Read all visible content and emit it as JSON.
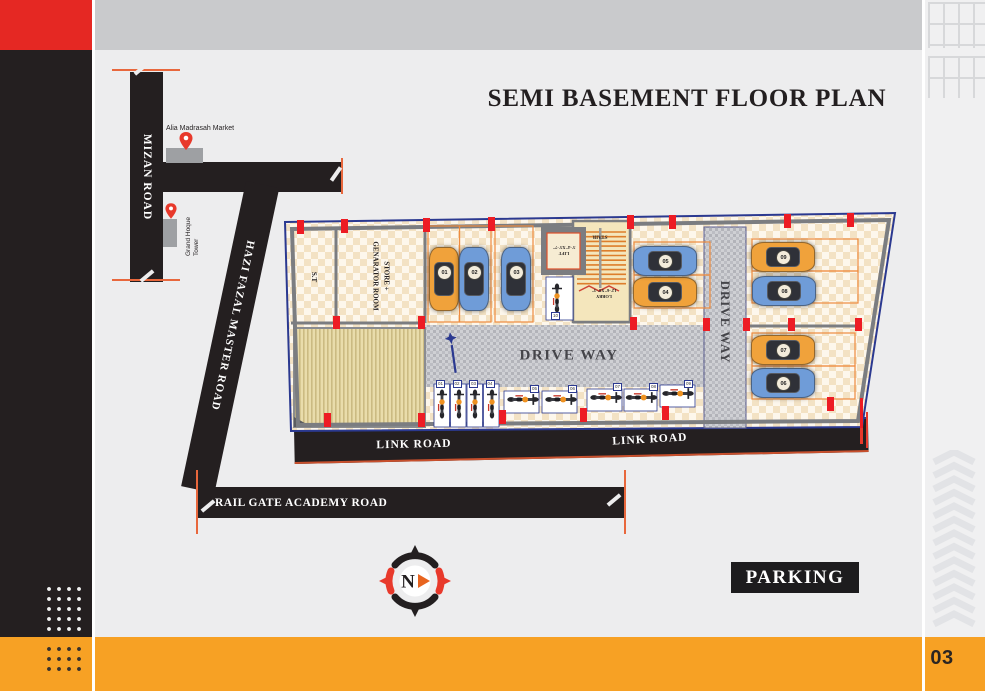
{
  "page": {
    "title": "SEMI BASEMENT FLOOR PLAN",
    "parking_badge": "PARKING",
    "page_number": "03",
    "colors": {
      "accent_red": "#ED1C24",
      "accent_orange": "#F7A124",
      "ink_black": "#231F20",
      "outline_navy": "#2B3990"
    }
  },
  "roads": {
    "mizan": "MIZAN ROAD",
    "hazi_fazal": "HAZI FAZAL MASTER ROAD",
    "link": "LINK ROAD",
    "rail_gate": "RAIL GATE ACADEMY ROAD"
  },
  "landmarks": [
    {
      "name": "Alia Madrasah Market"
    },
    {
      "name": "Grand Hoque Tower"
    }
  ],
  "floor_plan": {
    "rooms": {
      "st": "S.T",
      "store_line1": "STORE +",
      "store_line2": "GENARATOR ROOM",
      "lift_line1": "LIFT",
      "lift_line2": "5'-4\"X5'-7\"",
      "stair": "STAIR",
      "lobby_line1": "LOBBY",
      "lobby_line2": "12'-6\"X8'-3\""
    },
    "drive_way_h": "DRIVE WAY",
    "drive_way_v": "DRIVE WAY",
    "cars": [
      {
        "id": "01",
        "color": "orange"
      },
      {
        "id": "02",
        "color": "blue"
      },
      {
        "id": "03",
        "color": "blue"
      },
      {
        "id": "04",
        "color": "orange"
      },
      {
        "id": "05",
        "color": "blue"
      },
      {
        "id": "06",
        "color": "blue"
      },
      {
        "id": "07",
        "color": "orange"
      },
      {
        "id": "08",
        "color": "blue"
      },
      {
        "id": "09",
        "color": "orange"
      }
    ],
    "bikes": [
      "01",
      "02",
      "03",
      "04",
      "05",
      "06",
      "07",
      "08",
      "09",
      "10"
    ]
  },
  "compass": {
    "north": "N"
  }
}
